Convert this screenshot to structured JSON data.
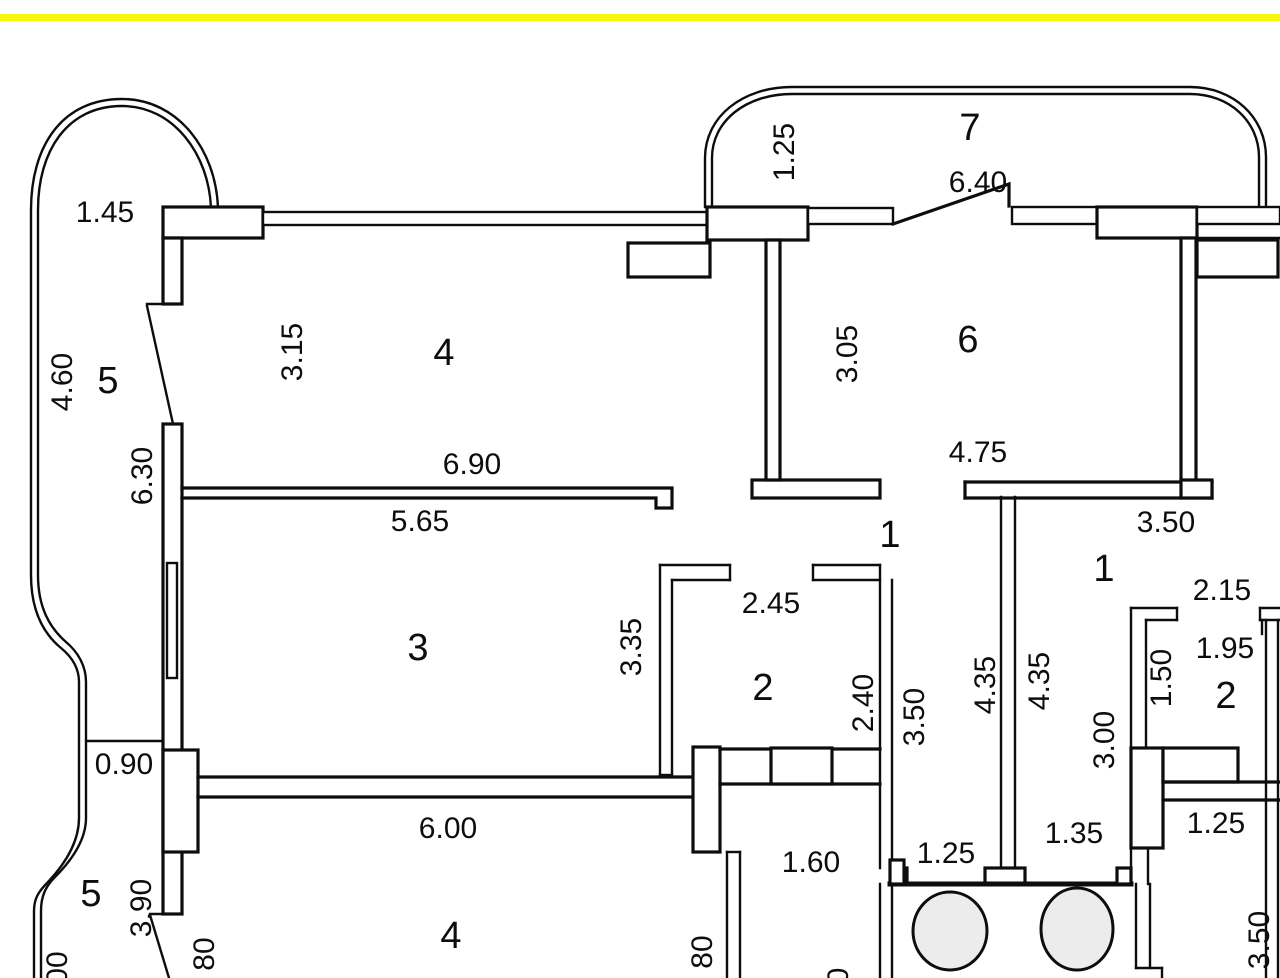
{
  "colors": {
    "highlight_bar": "#f6f60a",
    "wall_line": "#0d0d0d",
    "fixture_fill": "#ececec",
    "background": "#ffffff"
  },
  "plan": {
    "room_numbers": [
      {
        "text": "5",
        "x": 108,
        "y": 393,
        "rot": 0
      },
      {
        "text": "4",
        "x": 444,
        "y": 365,
        "rot": 0
      },
      {
        "text": "7",
        "x": 970,
        "y": 140,
        "rot": 0
      },
      {
        "text": "6",
        "x": 968,
        "y": 352,
        "rot": 0
      },
      {
        "text": "3",
        "x": 418,
        "y": 660,
        "rot": 0
      },
      {
        "text": "1",
        "x": 890,
        "y": 547,
        "rot": 0
      },
      {
        "text": "1",
        "x": 1104,
        "y": 581,
        "rot": 0
      },
      {
        "text": "2",
        "x": 763,
        "y": 700,
        "rot": 0
      },
      {
        "text": "2",
        "x": 1226,
        "y": 708,
        "rot": 0
      },
      {
        "text": "5",
        "x": 91,
        "y": 906,
        "rot": 0
      },
      {
        "text": "4",
        "x": 451,
        "y": 948,
        "rot": 0
      }
    ],
    "dimensions": [
      {
        "text": "1.45",
        "x": 105,
        "y": 222,
        "rot": 0
      },
      {
        "text": "4.60",
        "x": 62,
        "y": 382,
        "rot": -90
      },
      {
        "text": "3.15",
        "x": 292,
        "y": 352,
        "rot": -90
      },
      {
        "text": "6.30",
        "x": 142,
        "y": 476,
        "rot": -90
      },
      {
        "text": "6.90",
        "x": 472,
        "y": 474,
        "rot": 0
      },
      {
        "text": "5.65",
        "x": 420,
        "y": 531,
        "rot": 0
      },
      {
        "text": "1.25",
        "x": 784,
        "y": 152,
        "rot": -90
      },
      {
        "text": "6.40",
        "x": 978,
        "y": 192,
        "rot": 0
      },
      {
        "text": "3.05",
        "x": 847,
        "y": 354,
        "rot": -90
      },
      {
        "text": "4.75",
        "x": 978,
        "y": 462,
        "rot": 0
      },
      {
        "text": "3.50",
        "x": 1166,
        "y": 532,
        "rot": 0
      },
      {
        "text": "2.45",
        "x": 771,
        "y": 613,
        "rot": 0
      },
      {
        "text": "2.15",
        "x": 1222,
        "y": 600,
        "rot": 0
      },
      {
        "text": "3.35",
        "x": 631,
        "y": 647,
        "rot": -90
      },
      {
        "text": "1.95",
        "x": 1225,
        "y": 658,
        "rot": 0
      },
      {
        "text": "1.50",
        "x": 1161,
        "y": 678,
        "rot": -90
      },
      {
        "text": "2.40",
        "x": 863,
        "y": 703,
        "rot": -90
      },
      {
        "text": "3.50",
        "x": 914,
        "y": 717,
        "rot": -90
      },
      {
        "text": "4.35",
        "x": 985,
        "y": 685,
        "rot": -90
      },
      {
        "text": "4.35",
        "x": 1039,
        "y": 681,
        "rot": -90
      },
      {
        "text": "3.00",
        "x": 1104,
        "y": 740,
        "rot": -90
      },
      {
        "text": "0.90",
        "x": 124,
        "y": 774,
        "rot": 0
      },
      {
        "text": "6.00",
        "x": 448,
        "y": 838,
        "rot": 0
      },
      {
        "text": "1.35",
        "x": 1074,
        "y": 843,
        "rot": 0
      },
      {
        "text": "1.25",
        "x": 946,
        "y": 863,
        "rot": 0
      },
      {
        "text": "1.25",
        "x": 1216,
        "y": 833,
        "rot": 0
      },
      {
        "text": "1.60",
        "x": 811,
        "y": 872,
        "rot": 0
      },
      {
        "text": "3.90",
        "x": 141,
        "y": 908,
        "rot": -90
      },
      {
        "text": "00",
        "x": 57,
        "y": 968,
        "rot": -90
      },
      {
        "text": "80",
        "x": 204,
        "y": 954,
        "rot": -90
      },
      {
        "text": "80",
        "x": 702,
        "y": 952,
        "rot": -90
      },
      {
        "text": "0",
        "x": 838,
        "y": 976,
        "rot": -90
      },
      {
        "text": "3.50",
        "x": 1259,
        "y": 940,
        "rot": -90
      }
    ]
  }
}
